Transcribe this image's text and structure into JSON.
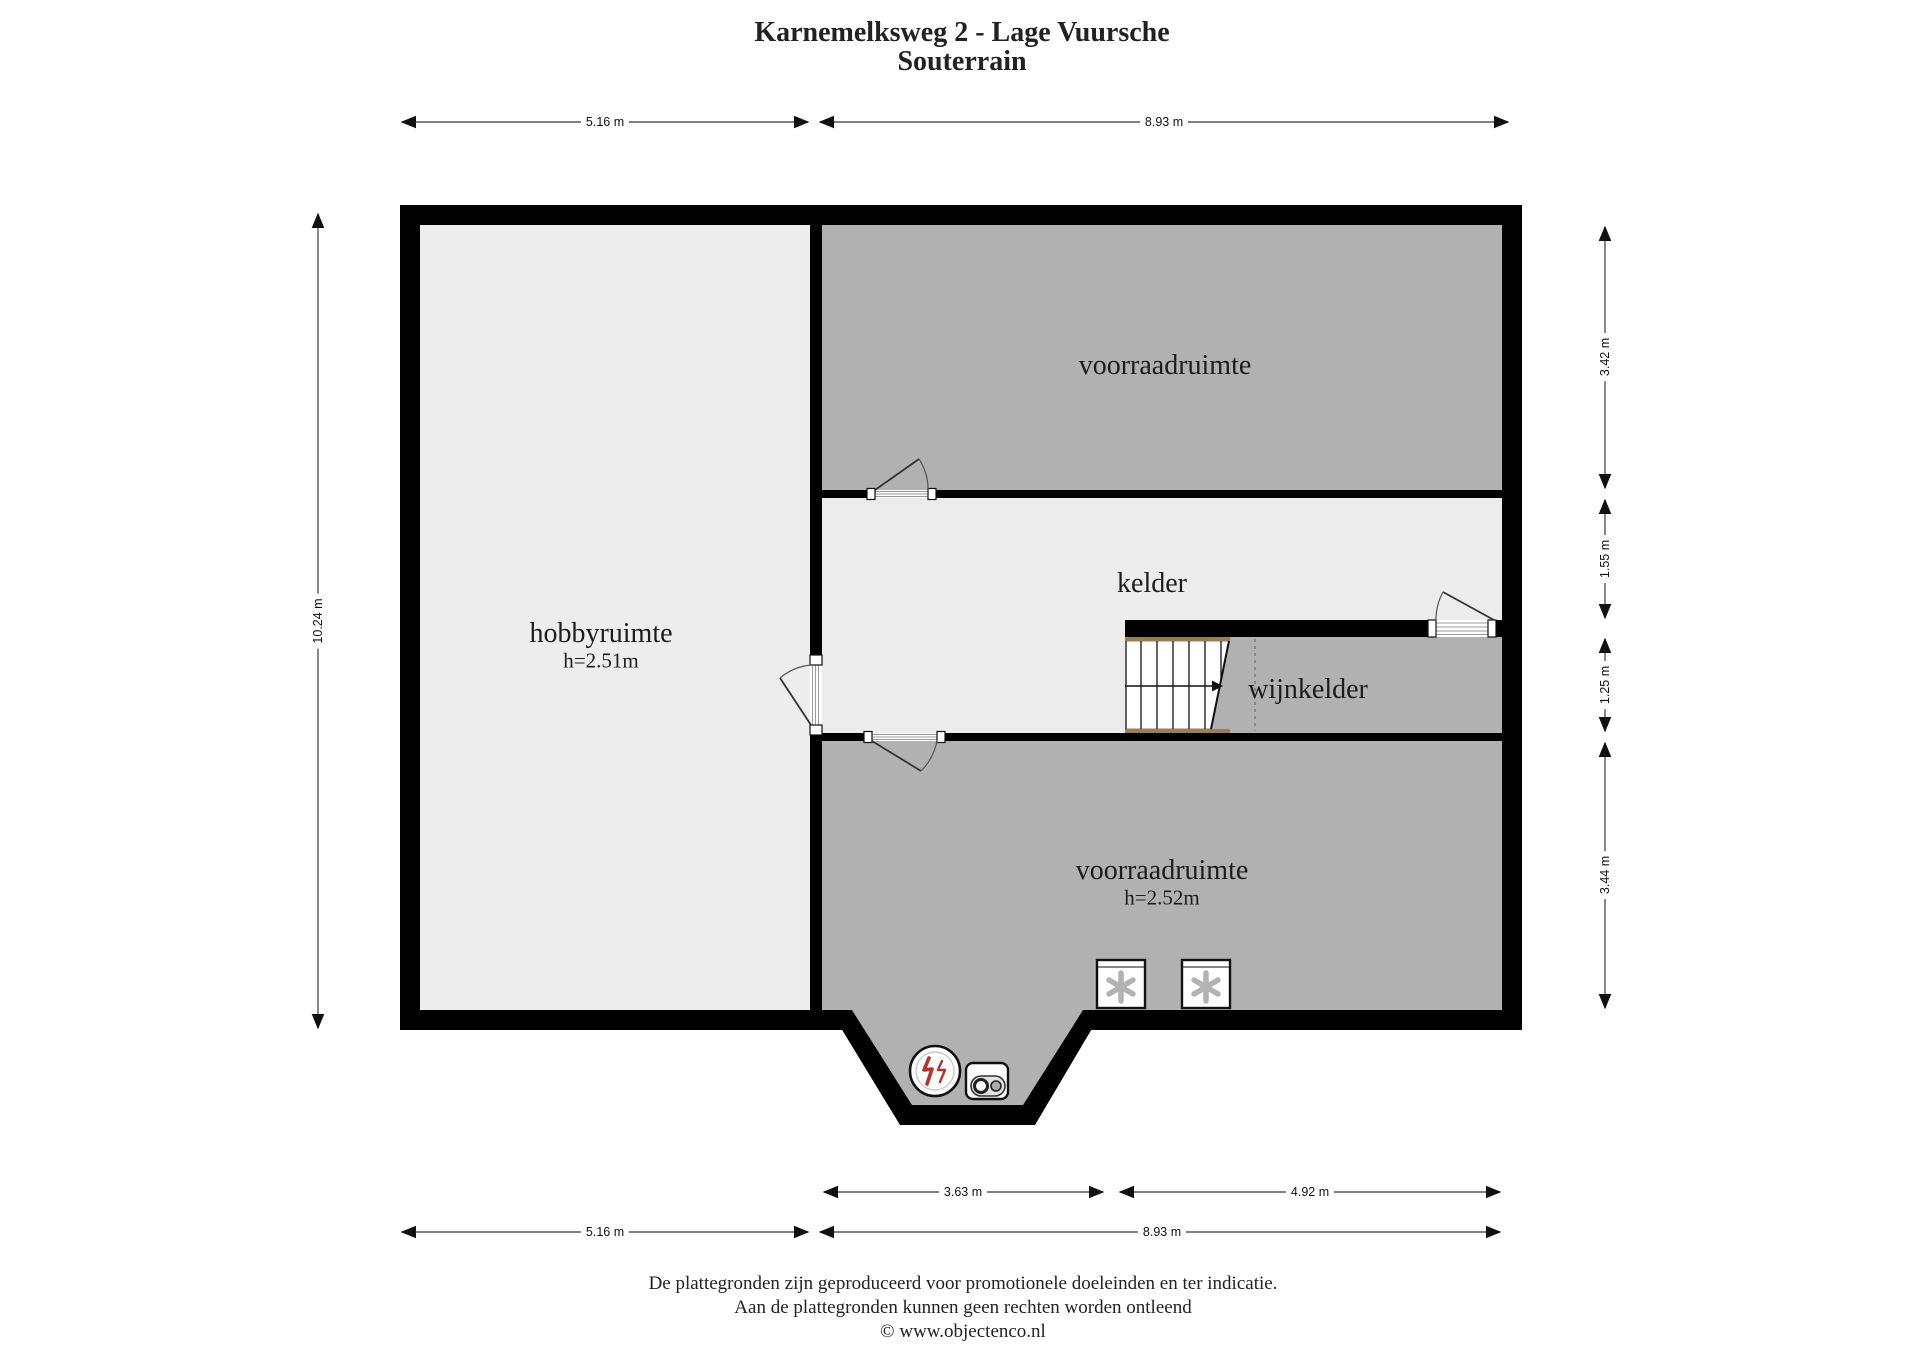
{
  "title": {
    "line1": "Karnemelksweg 2 - Lage Vuursche",
    "line2": "Souterrain"
  },
  "rooms": {
    "storage_top": {
      "name": "voorraadruimte"
    },
    "cellar": {
      "name": "kelder"
    },
    "wine_cellar": {
      "name": "wijnkelder"
    },
    "hobby": {
      "name": "hobbyruimte",
      "height": "h=2.51m"
    },
    "storage_bottom": {
      "name": "voorraadruimte",
      "height": "h=2.52m"
    }
  },
  "dimensions": {
    "top_left": "5.16 m",
    "top_right": "8.93 m",
    "left": "10.24 m",
    "right_1": "3.42 m",
    "right_2": "1.55 m",
    "right_3": "1.25 m",
    "right_4": "3.44 m",
    "bottom_inner_left": "3.63 m",
    "bottom_inner_right": "4.92 m",
    "bottom_outer_left": "5.16 m",
    "bottom_outer_right": "8.93 m"
  },
  "footer": {
    "line1": "De plattegronden zijn geproduceerd voor promotionele doeleinden en ter indicatie.",
    "line2": "Aan de plattegronden kunnen geen rechten worden ontleend",
    "line3": "© www.objectenco.nl"
  },
  "colors": {
    "wall": "#000000",
    "room_dark": "#b1b1b1",
    "room_light": "#ececec",
    "stair_rail": "#9b7f54",
    "flame_red": "#b5342c",
    "dimension_line": "#555555"
  }
}
